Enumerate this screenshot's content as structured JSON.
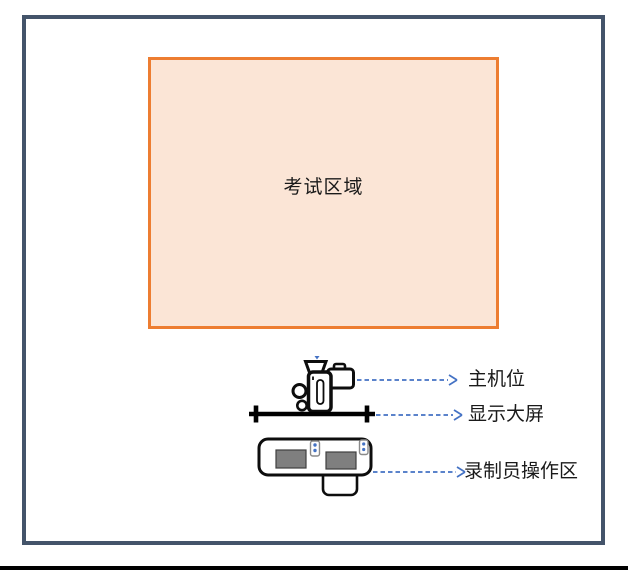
{
  "exam_area": {
    "label": "考试区域"
  },
  "annotations": [
    {
      "id": "main-camera",
      "label": "主机位",
      "icon": "video-camera-icon"
    },
    {
      "id": "display-screen",
      "label": "显示大屏",
      "icon": "screen-bar-shape"
    },
    {
      "id": "operator-area",
      "label": "录制员操作区",
      "icon": "desk-with-monitors-shape"
    }
  ],
  "icons": {
    "main_camera": "video-camera-icon",
    "display_screen": "screen-bar-shape",
    "operator_desk": "desk-with-monitors-shape",
    "operator_chair": "chair-shape",
    "monitors": "monitor-icon",
    "handheld_devices": "device-icon",
    "arrows": "dashed-arrow-right"
  },
  "colors": {
    "frame_border": "#44546A",
    "exam_area_border": "#ED7D31",
    "exam_area_fill": "#FBE5D6",
    "arrow": "#4472C4",
    "monitor_fill": "#7F7F7F",
    "text": "#1A1A1A"
  }
}
